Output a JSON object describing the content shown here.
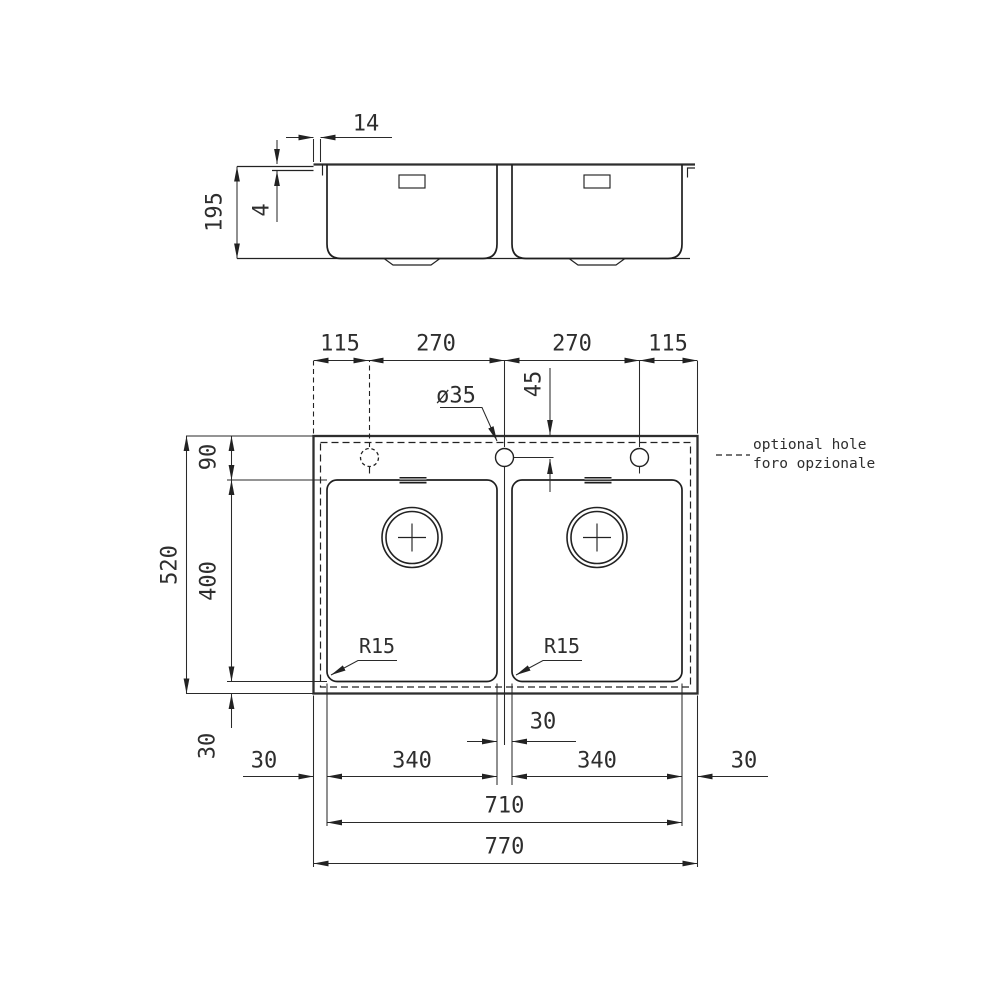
{
  "drawing": {
    "side_view": {
      "tab_width": "14",
      "rim_height": "4",
      "depth": "195"
    },
    "plan": {
      "top": {
        "left_margin": "115",
        "left_span": "270",
        "right_span": "270",
        "right_margin": "115"
      },
      "hole": {
        "diameter": "ø35",
        "offset_from_edge": "45"
      },
      "left": {
        "total_depth": "520",
        "top_margin": "90",
        "bowl_depth": "400",
        "bottom_margin": "30"
      },
      "bottom": {
        "left_margin": "30",
        "left_bowl": "340",
        "center_gap": "30",
        "right_bowl": "340",
        "right_margin": "30",
        "inner_width": "710",
        "total_width": "770"
      },
      "radius_left": "R15",
      "radius_right": "R15"
    },
    "legend": {
      "line1": "optional hole",
      "line2": "foro opzionale"
    },
    "colors": {
      "line": "#222222",
      "thick_line": "#2e2e2e",
      "text": "#2e2e2e",
      "background": "#ffffff"
    }
  }
}
